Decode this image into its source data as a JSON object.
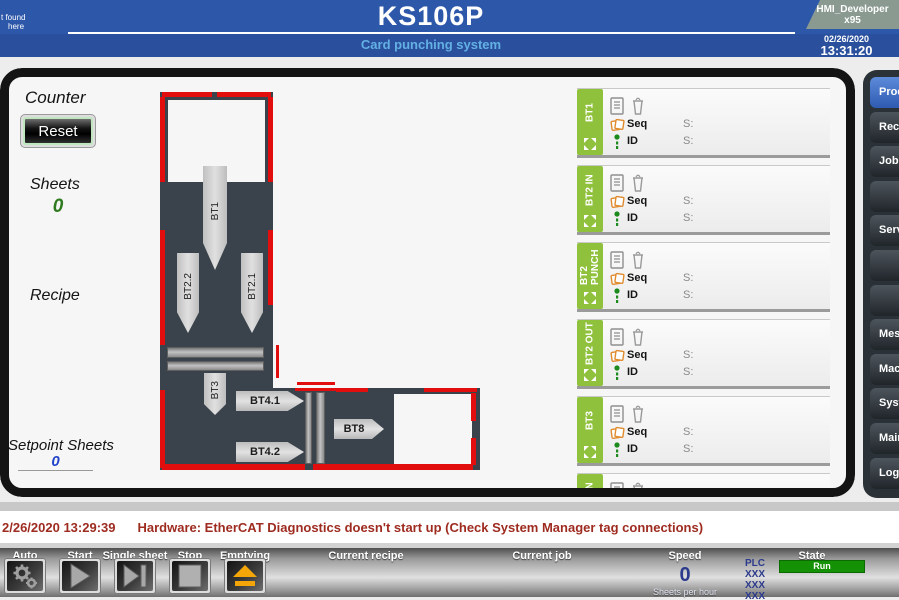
{
  "header": {
    "note_line1": "t found",
    "note_line2": "here",
    "title": "KS106P",
    "subtitle": "Card punching system",
    "badge_line1": "HMI_Developer",
    "badge_line2": "x95",
    "date": "02/26/2020",
    "time": "13:31:20"
  },
  "counter": {
    "label": "Counter",
    "reset": "Reset",
    "sheets_label": "Sheets",
    "sheets_value": "0",
    "recipe_label": "Recipe",
    "setpoint_label": "Setpoint Sheets",
    "setpoint_value": "0"
  },
  "machine": {
    "bt1": "BT1",
    "bt2_2": "BT2.2",
    "bt2_1": "BT2.1",
    "bt3": "BT3",
    "bt4_1": "BT4.1",
    "bt4_2": "BT4.2",
    "bt8": "BT8"
  },
  "status_panels": [
    {
      "tab": "BT1",
      "seq_label": "Seq",
      "seq_state": "S:",
      "id_label": "ID",
      "id_state": "S:"
    },
    {
      "tab": "BT2 IN",
      "seq_label": "Seq",
      "seq_state": "S:",
      "id_label": "ID",
      "id_state": "S:"
    },
    {
      "tab": "BT2\nPUNCH",
      "seq_label": "Seq",
      "seq_state": "S:",
      "id_label": "ID",
      "id_state": "S:"
    },
    {
      "tab": "BT2 OUT",
      "seq_label": "Seq",
      "seq_state": "S:",
      "id_label": "ID",
      "id_state": "S:"
    },
    {
      "tab": "BT3",
      "seq_label": "Seq",
      "seq_state": "S:",
      "id_label": "ID",
      "id_state": "S:"
    },
    {
      "tab": "BT4 IN",
      "seq_label": "Seq",
      "seq_state": "S:",
      "id_label": "ID",
      "id_state": "S:"
    }
  ],
  "menu": {
    "items": [
      "Prod",
      "Recip",
      "Job a",
      "",
      "Servi",
      "",
      "",
      "Mess",
      "Mach",
      "Syste",
      "Main",
      "Log"
    ],
    "active_index": 0
  },
  "alarm": {
    "timestamp": "2/26/2020 13:29:39",
    "message": "Hardware: EtherCAT Diagnostics doesn't start up (Check System Manager tag connections)"
  },
  "toolbar": {
    "auto": "Auto",
    "start": "Start",
    "single_sheet": "Single sheet",
    "stop": "Stop",
    "emptying": "Emptying",
    "current_recipe": "Current recipe",
    "current_job": "Current job",
    "speed_label": "Speed",
    "speed_value": "0",
    "speed_unit": "Sheets per hour",
    "plc_label": "PLC",
    "plc_row1": "XXX",
    "plc_row2": "XXX",
    "plc_row3": "XXX",
    "state_label": "State",
    "state_value": "Run"
  },
  "colors": {
    "header_blue": "#2d57a9",
    "subtitle_blue": "#63b0e4",
    "tab_green": "#8fc13c",
    "alarm_red": "#9e2b20",
    "state_green": "#149104",
    "machine_dark": "#3a434b",
    "machine_red": "#e20d0d",
    "active_menu_blue": "#2e5bb1",
    "speed_navy": "#2b3a8c",
    "emptying_orange": "#f4a609"
  }
}
